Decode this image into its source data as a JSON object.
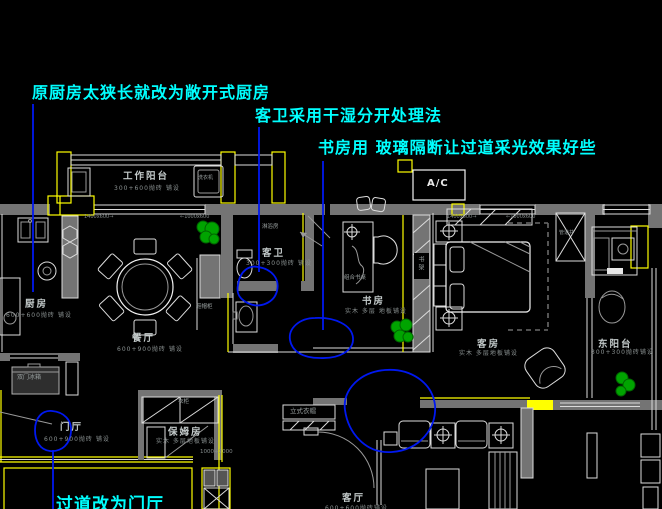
{
  "canvas": {
    "width": 662,
    "height": 509,
    "background": "#000000"
  },
  "colors": {
    "annotation": "#00ffff",
    "markup_blue": "#0018f0",
    "wall_gray": "#747474",
    "accent_yellow": "#ffff00",
    "line_white": "#dcdcdc",
    "plant_green": "#00a400"
  },
  "annotations": [
    {
      "id": "kitchen-note",
      "text": "原厨房太狭长就改为敞开式厨房"
    },
    {
      "id": "bath-note",
      "text": "客卫采用干湿分开处理法"
    },
    {
      "id": "study-note",
      "text": "书房用 玻璃隔断让过道采光效果好些"
    },
    {
      "id": "foyer-note",
      "text": "过道改为门厅"
    }
  ],
  "rooms": [
    {
      "name": "工作阳台",
      "spec": "300+600抛砖 铺设"
    },
    {
      "name": "厨房",
      "spec": "600+600抛砖 铺设"
    },
    {
      "name": "餐厅",
      "spec": "600+900抛砖 铺设"
    },
    {
      "name": "客卫",
      "spec": "300+300抛砖 铺设"
    },
    {
      "name": "书房",
      "spec": "实木 多层 地板铺设"
    },
    {
      "name": "客房",
      "spec": "实木 多层地板铺设"
    },
    {
      "name": "东阳台",
      "spec": "300+300抛砖铺设"
    },
    {
      "name": "保姆房",
      "spec": "实木 多层地板铺设"
    },
    {
      "name": "门厅",
      "spec": "600+900抛砖 铺设"
    },
    {
      "name": "客厅",
      "spec": "600+600抛砖铺设"
    }
  ],
  "fixtures": {
    "ac": "A/C",
    "washer": "洗衣机",
    "shower": "淋浴房",
    "desk": "组合书桌",
    "bookshelf": "书架",
    "wardrobe": "衣柜",
    "fridge": "双门冰箱",
    "shoe_cabinet": "鞋帽柜",
    "shaft": "管道井",
    "coat_rack": "立式衣帽"
  },
  "dimensions": {
    "maid_door": "1000+2000",
    "win_left_a": "1400x600→",
    "win_left_b": "←1000x600",
    "win_right_a": "1400x600→",
    "win_right_b": "←1000x600"
  }
}
